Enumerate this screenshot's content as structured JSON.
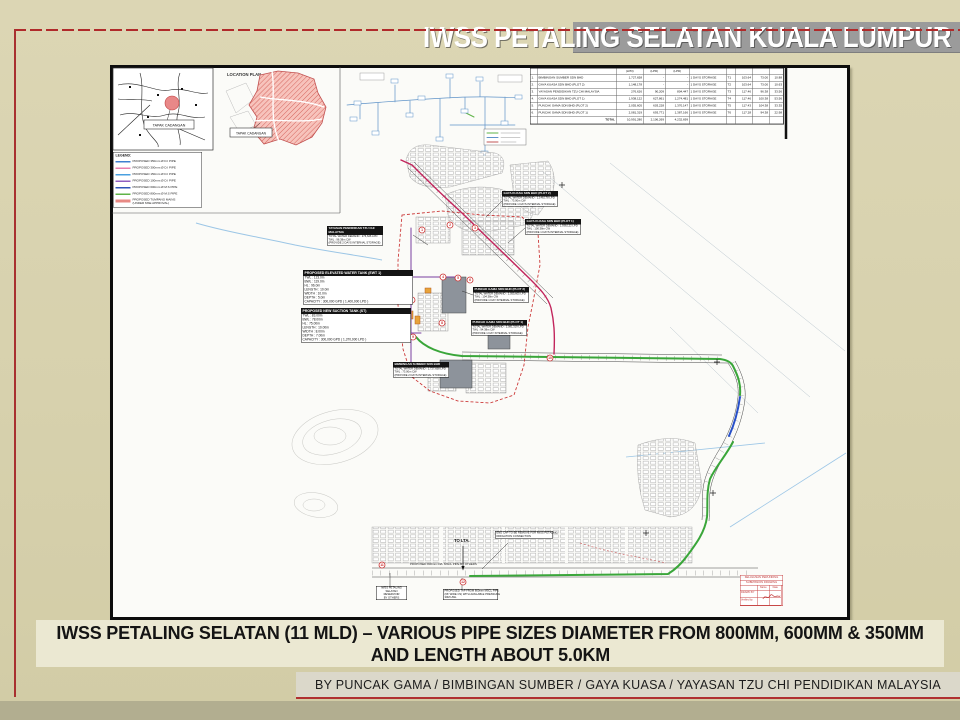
{
  "slide": {
    "title": "IWSS PETALING SELATAN KUALA LUMPUR",
    "caption_line1": "IWSS PETALING SELATAN (11 MLD) – VARIOUS PIPE SIZES DIAMETER FROM 800MM, 600MM & 350MM",
    "caption_line2": "AND LENGTH ABOUT 5.0KM",
    "credits": "BY PUNCAK GAMA / BIMBINGAN SUMBER / GAYA KUASA / YAYASAN TZU CHI PENDIDIKAN MALAYSIA"
  },
  "colors": {
    "accent_red": "#a83030",
    "title_bar_gray": "#9b9b9b",
    "pipe_magenta": "#c2255c",
    "pipe_purple": "#7a3fa0",
    "pipe_green": "#3aa63a",
    "pipe_blue": "#2850c8",
    "site_hatch_red": "#d25a52"
  },
  "drawing": {
    "key_plan": {
      "site_label": "TAPAK CADANGAN"
    },
    "location_plan": {
      "title": "LOCATION PLAN",
      "site_label": "TAPAK CADANGAN"
    },
    "legend": {
      "title": "LEGEND:",
      "items": [
        {
          "label": "PROPOSED 350mm Ø D.I PIPE",
          "color": "#3f7fd0"
        },
        {
          "label": "PROPOSED 300mm Ø D.I PIPE",
          "color": "#e87fb0"
        },
        {
          "label": "PROPOSED 150mm Ø D.I PIPE",
          "color": "#4aa0e0"
        },
        {
          "label": "PROPOSED 100mm Ø D.I PIPE",
          "color": "#8f5fc0"
        },
        {
          "label": "PROPOSED 600mm Ø M.S PIPE",
          "color": "#2f55b8"
        },
        {
          "label": "PROPOSED 800mm Ø M.S PIPE",
          "color": "#5fb347"
        },
        {
          "label": "PROPOSED TUMPANG MAINS",
          "label2": "(UNDER MSE APPROVAL)",
          "color": "#e88a84"
        }
      ]
    },
    "demand_table": {
      "lpd": "(LPD)",
      "rows": [
        {
          "no": "1.",
          "name": "BIMBINGAN SUMBER SDN BHD",
          "v1": "1,727,658",
          "v2": "-",
          "v3": "-",
          "storage": "1 DAYS STORAGE",
          "t": "T1",
          "a": "103.64",
          "b": "73.00",
          "c": "10.88"
        },
        {
          "no": "2.",
          "name": "GAYA KUASA SDN BHD (PLOT 2)",
          "v1": "1,148,178",
          "v2": "-",
          "v3": "-",
          "storage": "1 DAYS STORAGE",
          "t": "T2",
          "a": "103.64",
          "b": "73.00",
          "c": "10.63"
        },
        {
          "no": "3.",
          "name": "YAYASAN PENDIDIKAN TZU CHI MALAYSIA",
          "v1": "276,626",
          "v2": "90,209",
          "v3": "804,447",
          "storage": "1 DAYS STORAGE",
          "t": "T3",
          "a": "117.46",
          "b": "96.38",
          "c": "33.56"
        },
        {
          "no": "4.",
          "name": "GAYA KUASA SDN BHD (PLOT 1)",
          "v1": "1,938,122",
          "v2": "627,861",
          "v3": "1,274,481",
          "storage": "1 DAYS STORAGE",
          "t": "T4",
          "a": "117.46",
          "b": "100.38",
          "c": "53.56"
        },
        {
          "no": "5.",
          "name": "PUNCAK GAMA SDN BHD (PLOT 2)",
          "v1": "2,055,605",
          "v2": "603,228",
          "v3": "1,370,147",
          "storage": "1 DAYS STORAGE",
          "t": "T5",
          "a": "117.43",
          "b": "104.38",
          "c": "33.35"
        },
        {
          "no": "6.",
          "name": "PUNCAK GAMA SDN BHD (PLOT 1)",
          "v1": "2,081,319",
          "v2": "693,771",
          "v3": "1,387,166",
          "storage": "1 DAYS STORAGE",
          "t": "T6",
          "a": "117.28",
          "b": "94.38",
          "c": "22.98"
        }
      ],
      "total_label": "TOTAL",
      "total_v1": "10,991,280",
      "total_v2": "2,106,269",
      "total_v3": "4,232,699"
    },
    "notes": {
      "tzu_chi": {
        "title": "YAYASAN PENDIDIKAN TZU CHI MALAYSIA",
        "lines": [
          "TOTAL WATER DEMAND : 276,626 LPD",
          "TWL : 96.38m CW",
          "(PROVIDE 2 DAYS INTERNAL STORAGE)"
        ]
      },
      "ewt": {
        "title": "PROPOSED ELEVATED WATER TANK (EWT 1)",
        "lines": [
          "TWL : 123.0m",
          "BWL : 119.0m",
          "HL : 96.0m",
          "LENGTH : 10.0m",
          "WIDTH : 10.0m",
          "DEPTH : 5.0m",
          "CAPACITY : 300,000 GPD ( 1,400,000 LPD )"
        ]
      },
      "suction": {
        "title": "PROPOSED NEW SUCTION TANK (ST)",
        "lines": [
          "TWL : 83.00m",
          "BWL : 78.00m",
          "HL : 75.00m",
          "LENGTH : 10.00m",
          "WIDTH : 8.00m",
          "DEPTH : 7.00m",
          "CAPACITY : 300,000 GPD ( 1,370,000 LPD )"
        ]
      },
      "bimbingan": {
        "title": "BIMBINGAN SUMBER SDN BHD",
        "lines": [
          "TOTAL WATER DEMAND : 1,727,658 LPD",
          "TWL : 73.00m CW",
          "(PROVIDE 2 DAYS INTERNAL STORAGE)"
        ]
      },
      "gaya2": {
        "title": "GAYA KUASA SDN BHD (PLOT 2)",
        "lines": [
          "TOTAL WATER DEMAND : 1,148,178 LPD",
          "TWL : 73.00m CW",
          "(PROVIDE 1 DAYS INTERNAL STORAGE)"
        ]
      },
      "gaya1": {
        "title": "GAYA KUASA SDN BHD (PLOT 1)",
        "lines": [
          "TOTAL WATER DEMAND : 1,938,122 LPD",
          "TWL : 100.38m CW",
          "(PROVIDE 1 DAYS INTERNAL STORAGE)"
        ]
      },
      "puncak2": {
        "title": "PUNCAK GAMA SDN BHD (PLOT 2)",
        "lines": [
          "TOTAL WATER DEMAND : 2,055,605 LPD",
          "TWL : 104.38m CW",
          "(PROVIDE 1 DAY INTERNAL STORAGE)"
        ]
      },
      "puncak1": {
        "title": "PUNCAK GAMA SDN BHD (PLOT 1)",
        "lines": [
          "TOTAL WATER DEMAND : 2,081,319 LPD",
          "TWL : 94.38m CW",
          "(PROVIDE 1 DAY INTERNAL STORAGE)"
        ]
      },
      "endcap": {
        "lines": [
          "END CAP TO BE REMOVE FOR IWSS PETALING",
          "IRRIGATION CONNECTION"
        ]
      },
      "reservoir": {
        "lines": [
          "IWSS PETALING",
          "SELATAN",
          "RESERVOIR",
          "BY OTHERS"
        ]
      },
      "tap": {
        "lines": [
          "PROPOSED TAP FROM 800mm MSCL PIPE",
          "(66' WIDE CS) WITH AVAILABLE PRESSURE",
          "30M HWL"
        ]
      },
      "to_lta": "TO LTA.",
      "along_road": "PROPOSED 800mm DIA. MSCL PIPE BY OTHERS"
    },
    "markers": [
      "1",
      "2",
      "3",
      "4",
      "5",
      "6",
      "7",
      "8",
      "9",
      "10",
      "11",
      "12"
    ],
    "title_block": {
      "line1": "KELULUSAN PERUNDING",
      "line2": "SUBMISSION DRAWING",
      "col_name": "Name",
      "col_date": "Date",
      "row_drawn": "DRAWN BY",
      "row_verified": "Verified by"
    }
  }
}
